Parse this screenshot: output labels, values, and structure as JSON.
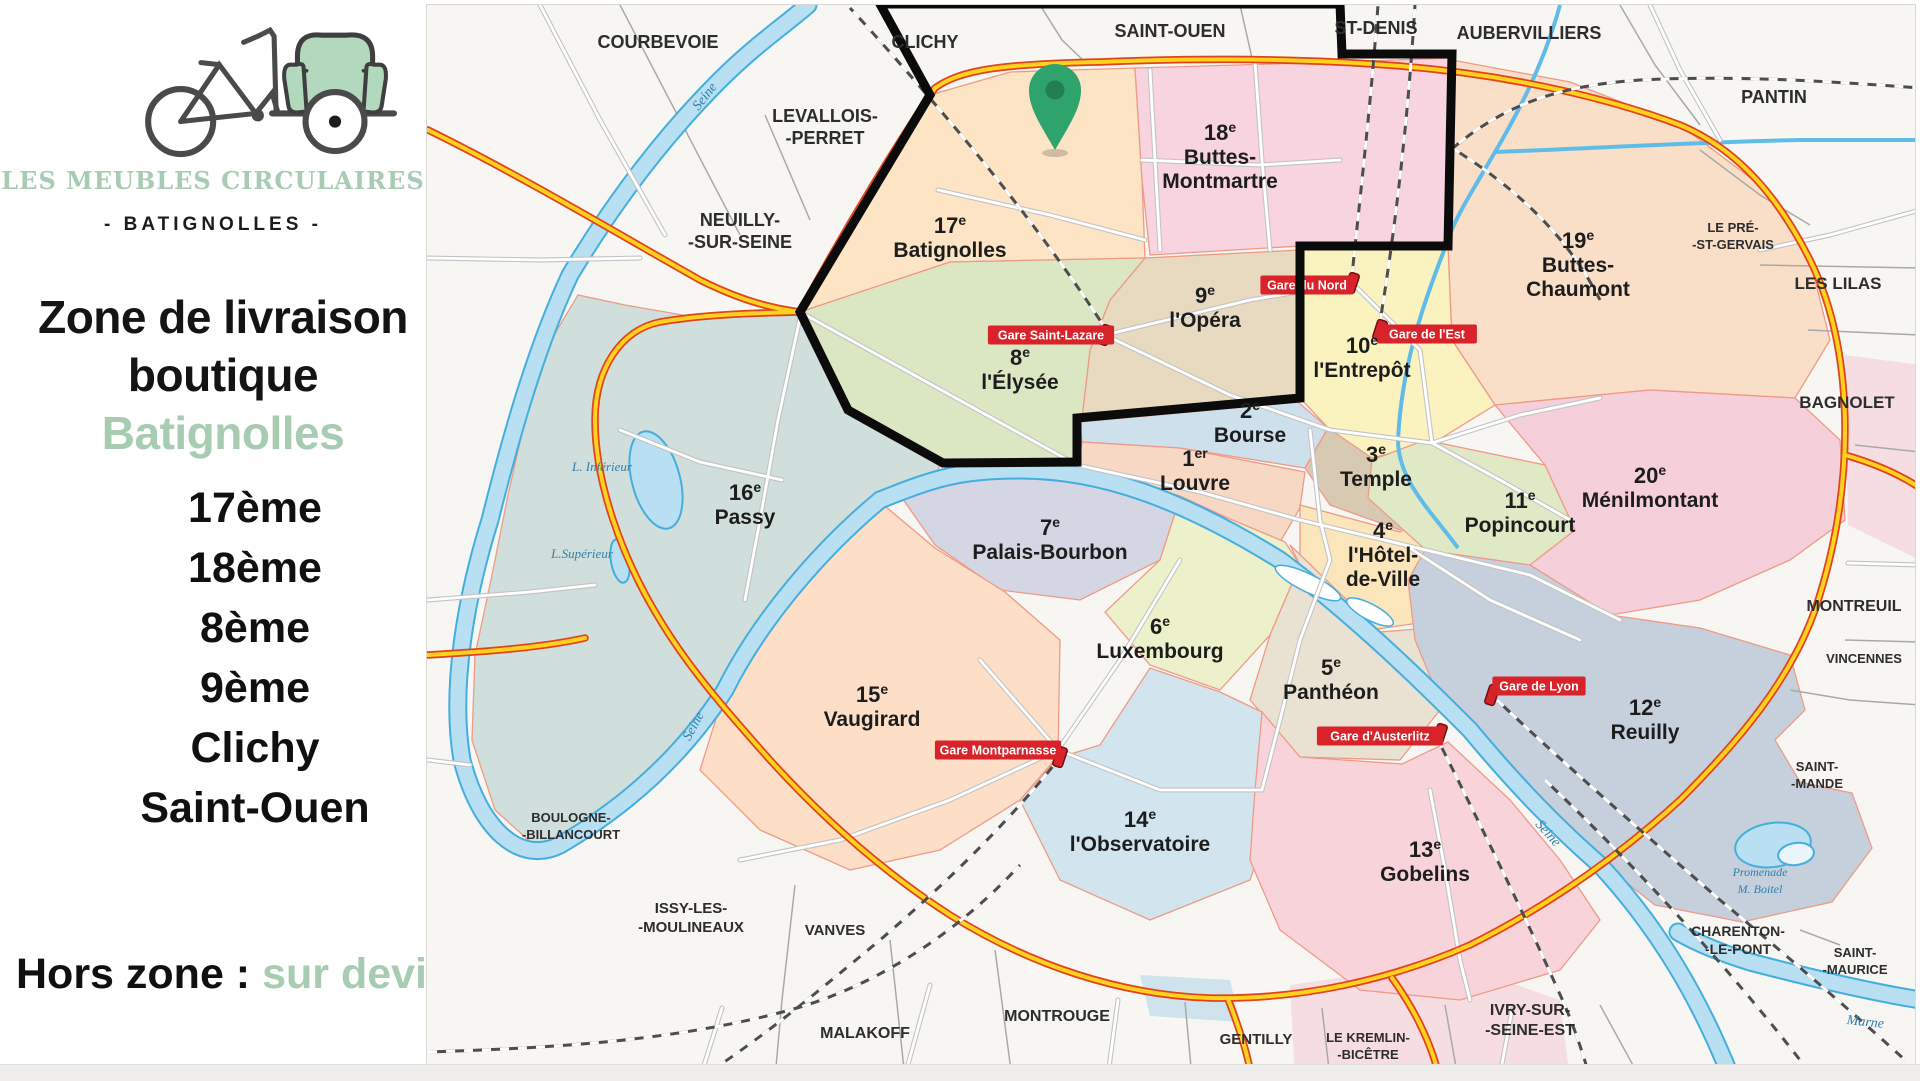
{
  "colors": {
    "accent_green": "#a7ccb2",
    "zone_outline": "#0b0b0b",
    "pin_green": "#2ea36b",
    "badge_red": "#d8232a",
    "ring_orange": "#e2431e",
    "ring_yellow": "#ffd21e",
    "water_blue": "#b8e0f2"
  },
  "brand": {
    "name": "Les Meubles Circulaires",
    "sub": "- Batignolles -"
  },
  "panel": {
    "title1": "Zone de livraison",
    "title2_black": "boutique ",
    "title2_green": "Batignolles",
    "zones": [
      "17ème",
      "18ème",
      "8ème",
      "9ème",
      "Clichy",
      "Saint-Ouen"
    ],
    "footer_black": "Hors  zone : ",
    "footer_green": "sur devis"
  },
  "map": {
    "districts": [
      {
        "num": "17",
        "sup": "e",
        "name": [
          "Batignolles"
        ],
        "x": 950,
        "y": 233,
        "color": "#fce4c4"
      },
      {
        "num": "18",
        "sup": "e",
        "name": [
          "Buttes-",
          "Montmartre"
        ],
        "x": 1220,
        "y": 140,
        "color": "#f8d3e0"
      },
      {
        "num": "19",
        "sup": "e",
        "name": [
          "Buttes-",
          "Chaumont"
        ],
        "x": 1578,
        "y": 248,
        "color": "#fadfc8"
      },
      {
        "num": "9",
        "sup": "e",
        "name": [
          "l'Opéra"
        ],
        "x": 1205,
        "y": 303,
        "color": "#e7dac0"
      },
      {
        "num": "10",
        "sup": "e",
        "name": [
          "l'Entrepôt"
        ],
        "x": 1362,
        "y": 353,
        "color": "#faf3c0"
      },
      {
        "num": "8",
        "sup": "e",
        "name": [
          "l'Élysée"
        ],
        "x": 1020,
        "y": 365,
        "color": "#dbe7c2"
      },
      {
        "num": "2",
        "sup": "e",
        "name": [
          "Bourse"
        ],
        "x": 1250,
        "y": 418,
        "color": "#cde0ec"
      },
      {
        "num": "1",
        "sup": "er",
        "name": [
          "Louvre"
        ],
        "x": 1195,
        "y": 466,
        "color": "#f7d8c5"
      },
      {
        "num": "3",
        "sup": "e",
        "name": [
          "Temple"
        ],
        "x": 1376,
        "y": 462,
        "color": "#d8c9b2"
      },
      {
        "num": "4",
        "sup": "e",
        "name": [
          "l'Hôtel-",
          "de-Ville"
        ],
        "x": 1383,
        "y": 538,
        "color": "#fbe6bb"
      },
      {
        "num": "11",
        "sup": "e",
        "name": [
          "Popincourt"
        ],
        "x": 1520,
        "y": 508,
        "color": "#dfe9c6"
      },
      {
        "num": "20",
        "sup": "e",
        "name": [
          "Ménilmontant"
        ],
        "x": 1650,
        "y": 483,
        "color": "#f5d0da"
      },
      {
        "num": "16",
        "sup": "e",
        "name": [
          "Passy"
        ],
        "x": 745,
        "y": 500,
        "color": "#d0dfdb"
      },
      {
        "num": "7",
        "sup": "e",
        "name": [
          "Palais-Bourbon"
        ],
        "x": 1050,
        "y": 535,
        "color": "#d5d6e3"
      },
      {
        "num": "6",
        "sup": "e",
        "name": [
          "Luxembourg"
        ],
        "x": 1160,
        "y": 634,
        "color": "#ecf1cc"
      },
      {
        "num": "5",
        "sup": "e",
        "name": [
          "Panthéon"
        ],
        "x": 1331,
        "y": 675,
        "color": "#e9e2d2"
      },
      {
        "num": "15",
        "sup": "e",
        "name": [
          "Vaugirard"
        ],
        "x": 872,
        "y": 702,
        "color": "#fcdfc6"
      },
      {
        "num": "14",
        "sup": "e",
        "name": [
          "l'Observatoire"
        ],
        "x": 1140,
        "y": 827,
        "color": "#d2e5ee"
      },
      {
        "num": "13",
        "sup": "e",
        "name": [
          "Gobelins"
        ],
        "x": 1425,
        "y": 857,
        "color": "#f8d4da"
      },
      {
        "num": "12",
        "sup": "e",
        "name": [
          "Reuilly"
        ],
        "x": 1645,
        "y": 715,
        "color": "#c6d0dc"
      }
    ],
    "suburbs": [
      {
        "name": [
          "COURBEVOIE"
        ],
        "x": 658,
        "y": 48,
        "s": 18
      },
      {
        "name": [
          "CLICHY"
        ],
        "x": 925,
        "y": 48,
        "s": 18
      },
      {
        "name": [
          "SAINT-OUEN"
        ],
        "x": 1170,
        "y": 37,
        "s": 18
      },
      {
        "name": [
          "ST-DENIS"
        ],
        "x": 1376,
        "y": 34,
        "s": 18
      },
      {
        "name": [
          "AUBERVILLIERS"
        ],
        "x": 1529,
        "y": 39,
        "s": 18
      },
      {
        "name": [
          "PANTIN"
        ],
        "x": 1774,
        "y": 103,
        "s": 18
      },
      {
        "name": [
          "LEVALLOIS-",
          "-PERRET"
        ],
        "x": 825,
        "y": 122,
        "s": 18
      },
      {
        "name": [
          "NEUILLY-",
          "-SUR-SEINE"
        ],
        "x": 740,
        "y": 226,
        "s": 18
      },
      {
        "name": [
          "LE PRÉ-",
          "-ST-GERVAIS"
        ],
        "x": 1733,
        "y": 232,
        "s": 13
      },
      {
        "name": [
          "LES LILAS"
        ],
        "x": 1838,
        "y": 289,
        "s": 17
      },
      {
        "name": [
          "BAGNOLET"
        ],
        "x": 1847,
        "y": 408,
        "s": 17
      },
      {
        "name": [
          "MONTREUIL"
        ],
        "x": 1854,
        "y": 611,
        "s": 16
      },
      {
        "name": [
          "VINCENNES"
        ],
        "x": 1864,
        "y": 663,
        "s": 13
      },
      {
        "name": [
          "SAINT-",
          "-MANDE"
        ],
        "x": 1817,
        "y": 771,
        "s": 13
      },
      {
        "name": [
          "CHARENTON-",
          "-LE-PONT"
        ],
        "x": 1738,
        "y": 936,
        "s": 14
      },
      {
        "name": [
          "SAINT-",
          "-MAURICE"
        ],
        "x": 1855,
        "y": 957,
        "s": 13
      },
      {
        "name": [
          "IVRY-SUR-",
          "-SEINE-EST"
        ],
        "x": 1530,
        "y": 1015,
        "s": 16
      },
      {
        "name": [
          "LE KREMLIN-",
          "-BICÊTRE"
        ],
        "x": 1368,
        "y": 1042,
        "s": 13
      },
      {
        "name": [
          "GENTILLY"
        ],
        "x": 1256,
        "y": 1044,
        "s": 15
      },
      {
        "name": [
          "MONTROUGE"
        ],
        "x": 1057,
        "y": 1021,
        "s": 16
      },
      {
        "name": [
          "MALAKOFF"
        ],
        "x": 865,
        "y": 1038,
        "s": 16
      },
      {
        "name": [
          "VANVES"
        ],
        "x": 835,
        "y": 935,
        "s": 15
      },
      {
        "name": [
          "ISSY-LES-",
          "-MOULINEAUX"
        ],
        "x": 691,
        "y": 913,
        "s": 15
      },
      {
        "name": [
          "BOULOGNE-",
          "-BILLANCOURT"
        ],
        "x": 571,
        "y": 822,
        "s": 13
      }
    ],
    "stations": [
      {
        "label": "Gare Saint-Lazare",
        "bx": 1051,
        "by": 335,
        "ix": 1105,
        "iy": 335
      },
      {
        "label": "Gare du Nord",
        "bx": 1307,
        "by": 285,
        "ix": 1352,
        "iy": 283
      },
      {
        "label": "Gare de l'Est",
        "bx": 1427,
        "by": 334,
        "ix": 1380,
        "iy": 330
      },
      {
        "label": "Gare de Lyon",
        "bx": 1539,
        "by": 686,
        "ix": 1492,
        "iy": 695
      },
      {
        "label": "Gare d'Austerlitz",
        "bx": 1380,
        "by": 736,
        "ix": 1440,
        "iy": 734
      },
      {
        "label": "Gare Montparnasse",
        "bx": 998,
        "by": 750,
        "ix": 1060,
        "iy": 757
      }
    ],
    "water_labels": [
      {
        "t": "Seine",
        "x": 708,
        "y": 99,
        "r": -52,
        "s": 14
      },
      {
        "t": "Seine",
        "x": 697,
        "y": 728,
        "r": -62,
        "s": 14
      },
      {
        "t": "Seine",
        "x": 1545,
        "y": 836,
        "r": 48,
        "s": 14
      },
      {
        "t": "Marne",
        "x": 1865,
        "y": 1026,
        "r": 6,
        "s": 14
      },
      {
        "t": "L. Inférieur",
        "x": 602,
        "y": 471,
        "r": 0,
        "s": 13
      },
      {
        "t": "L.Supérieur",
        "x": 582,
        "y": 558,
        "r": 0,
        "s": 13
      },
      {
        "t": "Promenade",
        "x": 1760,
        "y": 876,
        "r": 0,
        "s": 12
      },
      {
        "t": "M. Boitel",
        "x": 1760,
        "y": 893,
        "r": 0,
        "s": 12
      }
    ],
    "pin": {
      "x": 1055,
      "y": 150
    }
  }
}
